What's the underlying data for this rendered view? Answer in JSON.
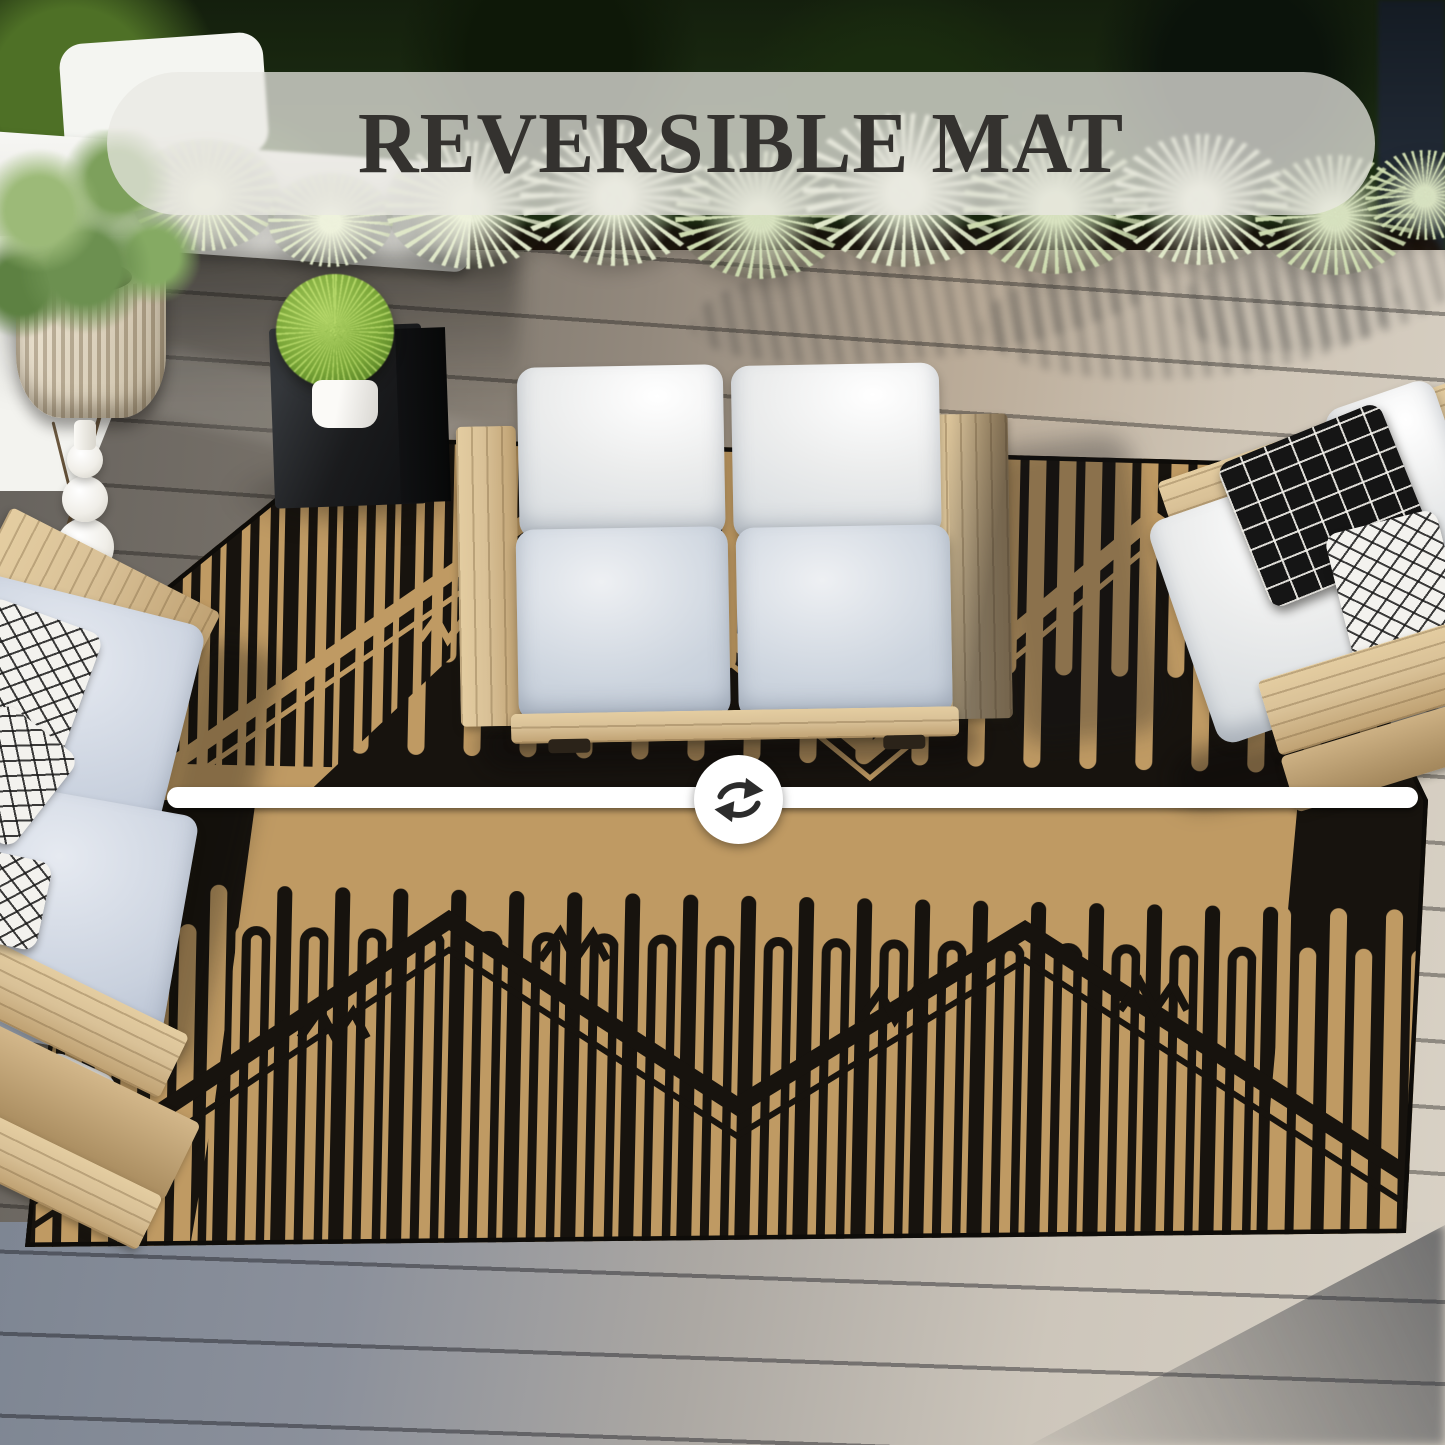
{
  "banner": {
    "label": "REVERSIBLE MAT"
  },
  "divider": {
    "icon": "swap-arrows-icon"
  },
  "colors": {
    "rug_tan": "#bf9a63",
    "rug_black": "#17130e",
    "banner_bg": "rgba(233,232,226,0.74)",
    "banner_text": "#34322f",
    "bar_white": "#ffffff",
    "icon_dark": "#2c2c2c",
    "deck_light": "#d8d1c5",
    "deck_blue": "#7e8693",
    "wood_light": "#d9c197",
    "cushion_white": "#eceded",
    "cushion_blue": "#bcc6d4",
    "agave_pale": "#dfe7c8"
  }
}
